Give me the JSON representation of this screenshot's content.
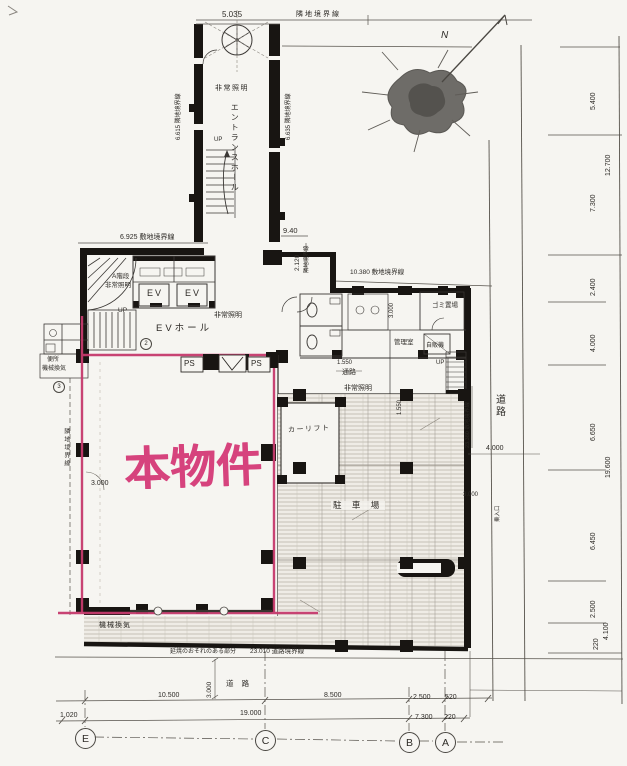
{
  "colors": {
    "highlight": "#c63a6d",
    "highlight_text": "#d6437d",
    "ink": "#2e2b27",
    "wall": "#181512",
    "paper": "#f6f5f1"
  },
  "property": {
    "label": "本物件"
  },
  "rooms": {
    "entrance_hall": "エントランスホール",
    "ev_hall": "EVホール",
    "ev1": "EV",
    "ev2": "EV",
    "stair_a": "A階段",
    "parking": "駐 車 場",
    "car_lift": "カーリフト",
    "garbage": "ゴミ置場",
    "vending": "自販機",
    "manager": "管理室",
    "corridor": "通路",
    "toilet": "便所",
    "toilet_vent": "機械換気",
    "mech_vent": "機械換気",
    "road_bottom": "道 路",
    "road_right": "道路",
    "entry_note": "乗入口",
    "ps1": "PS",
    "ps2": "PS",
    "up1": "UP",
    "up2": "UP",
    "up3": "UP",
    "emergency1": "非常照明",
    "emergency2": "非常照明",
    "emergency3": "非常照明",
    "emergency4": "非常照明"
  },
  "boundaries": {
    "adjacent_top": "隣地境界線",
    "left_upper": "6.615 隣地境界線",
    "right_upper": "6.635 隣地境界線",
    "site_top": "6.925 敷地境界線",
    "site_mid": "10.380 敷地境界線",
    "east_small": "隣地境界線",
    "right_site": "23.380 敷地境界線",
    "left_lower": "隣地境界線",
    "road": "23.010 道路境界線",
    "fire_note": "延焼のおそれのある部分"
  },
  "dims": {
    "top": "5.035",
    "d940": "9.40",
    "d2120": "2.120",
    "left_3000": "3.000",
    "mid_3000": "3.000",
    "bottom_3000": "3.000",
    "h1550": "1.550",
    "v1550": "1.550",
    "right_4000": "4.000",
    "right_3000": "3.000",
    "col_5400": "5.400",
    "col_12700": "12.700",
    "col_7300": "7.300",
    "col_2400": "2.400",
    "col_4000": "4.000",
    "col_6650": "6.650",
    "col_19600": "19.600",
    "col_6450": "6.450",
    "col_2500": "2.500",
    "col_4100": "4.100",
    "col_220": "220",
    "row1_10500": "10.500",
    "row1_8500": "8.500",
    "row1_2500": "2.500",
    "row1_520": "520",
    "row2_1020": "1.020",
    "row2_19000": "19.000",
    "row2_7300": "7.300",
    "row2_220": "220"
  },
  "grid": {
    "e": "E",
    "c": "C",
    "b": "B",
    "a": "A"
  },
  "north": {
    "label": "N"
  },
  "annotations": {
    "c2": "2",
    "c3": "3"
  }
}
